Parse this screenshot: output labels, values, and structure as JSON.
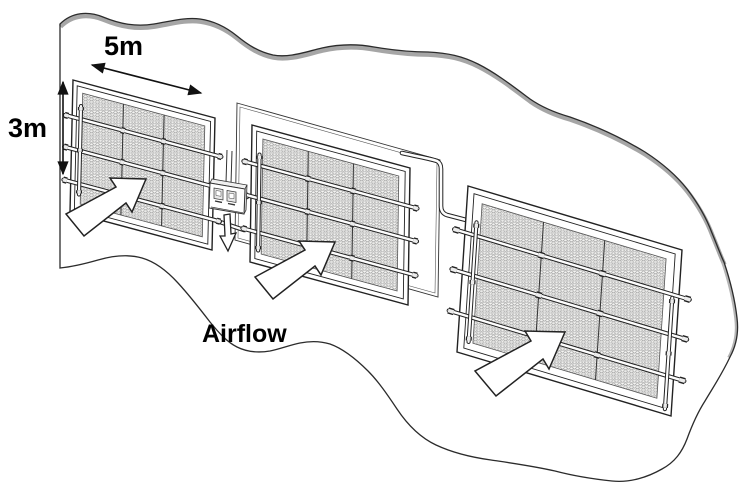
{
  "diagram": {
    "labels": {
      "panel_width": "5m",
      "panel_height": "3m",
      "airflow": "Airflow"
    },
    "panel_count": 3,
    "mesh_grid": {
      "columns": 3,
      "rows": 4
    },
    "pipes_per_panel": 3,
    "icons": [
      "airflow-block-arrow",
      "drain-down-arrow",
      "width-dimension-arrow",
      "height-dimension-arrow"
    ],
    "colors": {
      "outline": "#2b2b2b",
      "boundary_shading": "#a6a6a6",
      "mesh_line": "#9a9a9a",
      "mesh_bg": "#f6f6f4",
      "arrow_fill": "#ffffff",
      "text": "#000000"
    }
  }
}
